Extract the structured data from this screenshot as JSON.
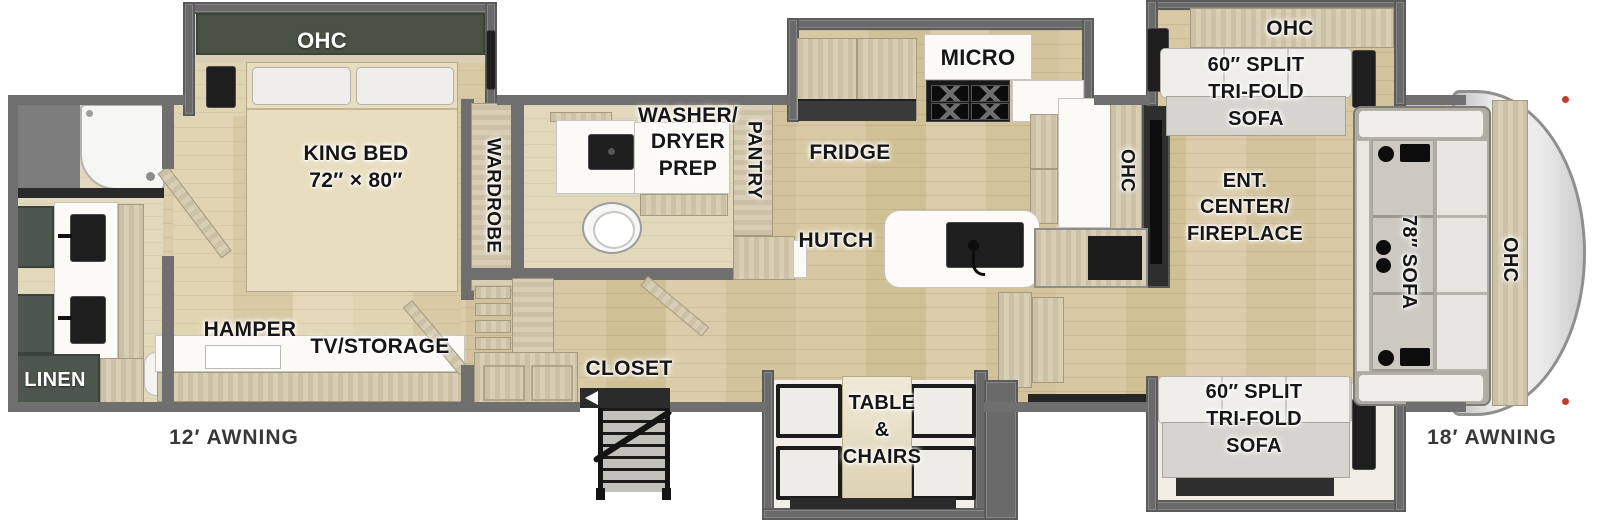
{
  "diagram": "RV fifth-wheel floor plan",
  "labels": {
    "bed_ohc": "OHC",
    "king_bed": [
      "KING BED",
      "72″ × 80″"
    ],
    "wardrobe": "WARDROBE",
    "washer_dryer_prep": [
      "WASHER/",
      "DRYER",
      "PREP"
    ],
    "pantry": "PANTRY",
    "linen": "LINEN",
    "hamper": "HAMPER",
    "tv_storage": "TV/STORAGE",
    "awning_left": "12′ AWNING",
    "closet": "CLOSET",
    "micro": "MICRO",
    "fridge": "FRIDGE",
    "hutch": "HUTCH",
    "kitchen_ohc": "OHC",
    "ent_center": [
      "ENT.",
      "CENTER/",
      "FIREPLACE"
    ],
    "sofa_top_ohc": "OHC",
    "sofa_top": [
      "60″ SPLIT",
      "TRI-FOLD",
      "SOFA"
    ],
    "sofa_bottom": [
      "60″ SPLIT",
      "TRI-FOLD",
      "SOFA"
    ],
    "sofa_78": "78″ SOFA",
    "front_ohc": "OHC",
    "table_chairs": [
      "TABLE",
      "&",
      "CHAIRS"
    ],
    "awning_right": "18′ AWNING"
  },
  "colors": {
    "floor_wood": "#d6c7a2",
    "wall_gray": "#6f6f6f",
    "cabinet_tan": "#d6cbb0",
    "cabinet_dark_green": "#4d564c",
    "fixture_dark": "#1e1e1e",
    "slide_gray": "#6a6a6a",
    "tail_light_red": "#c23b2e"
  }
}
